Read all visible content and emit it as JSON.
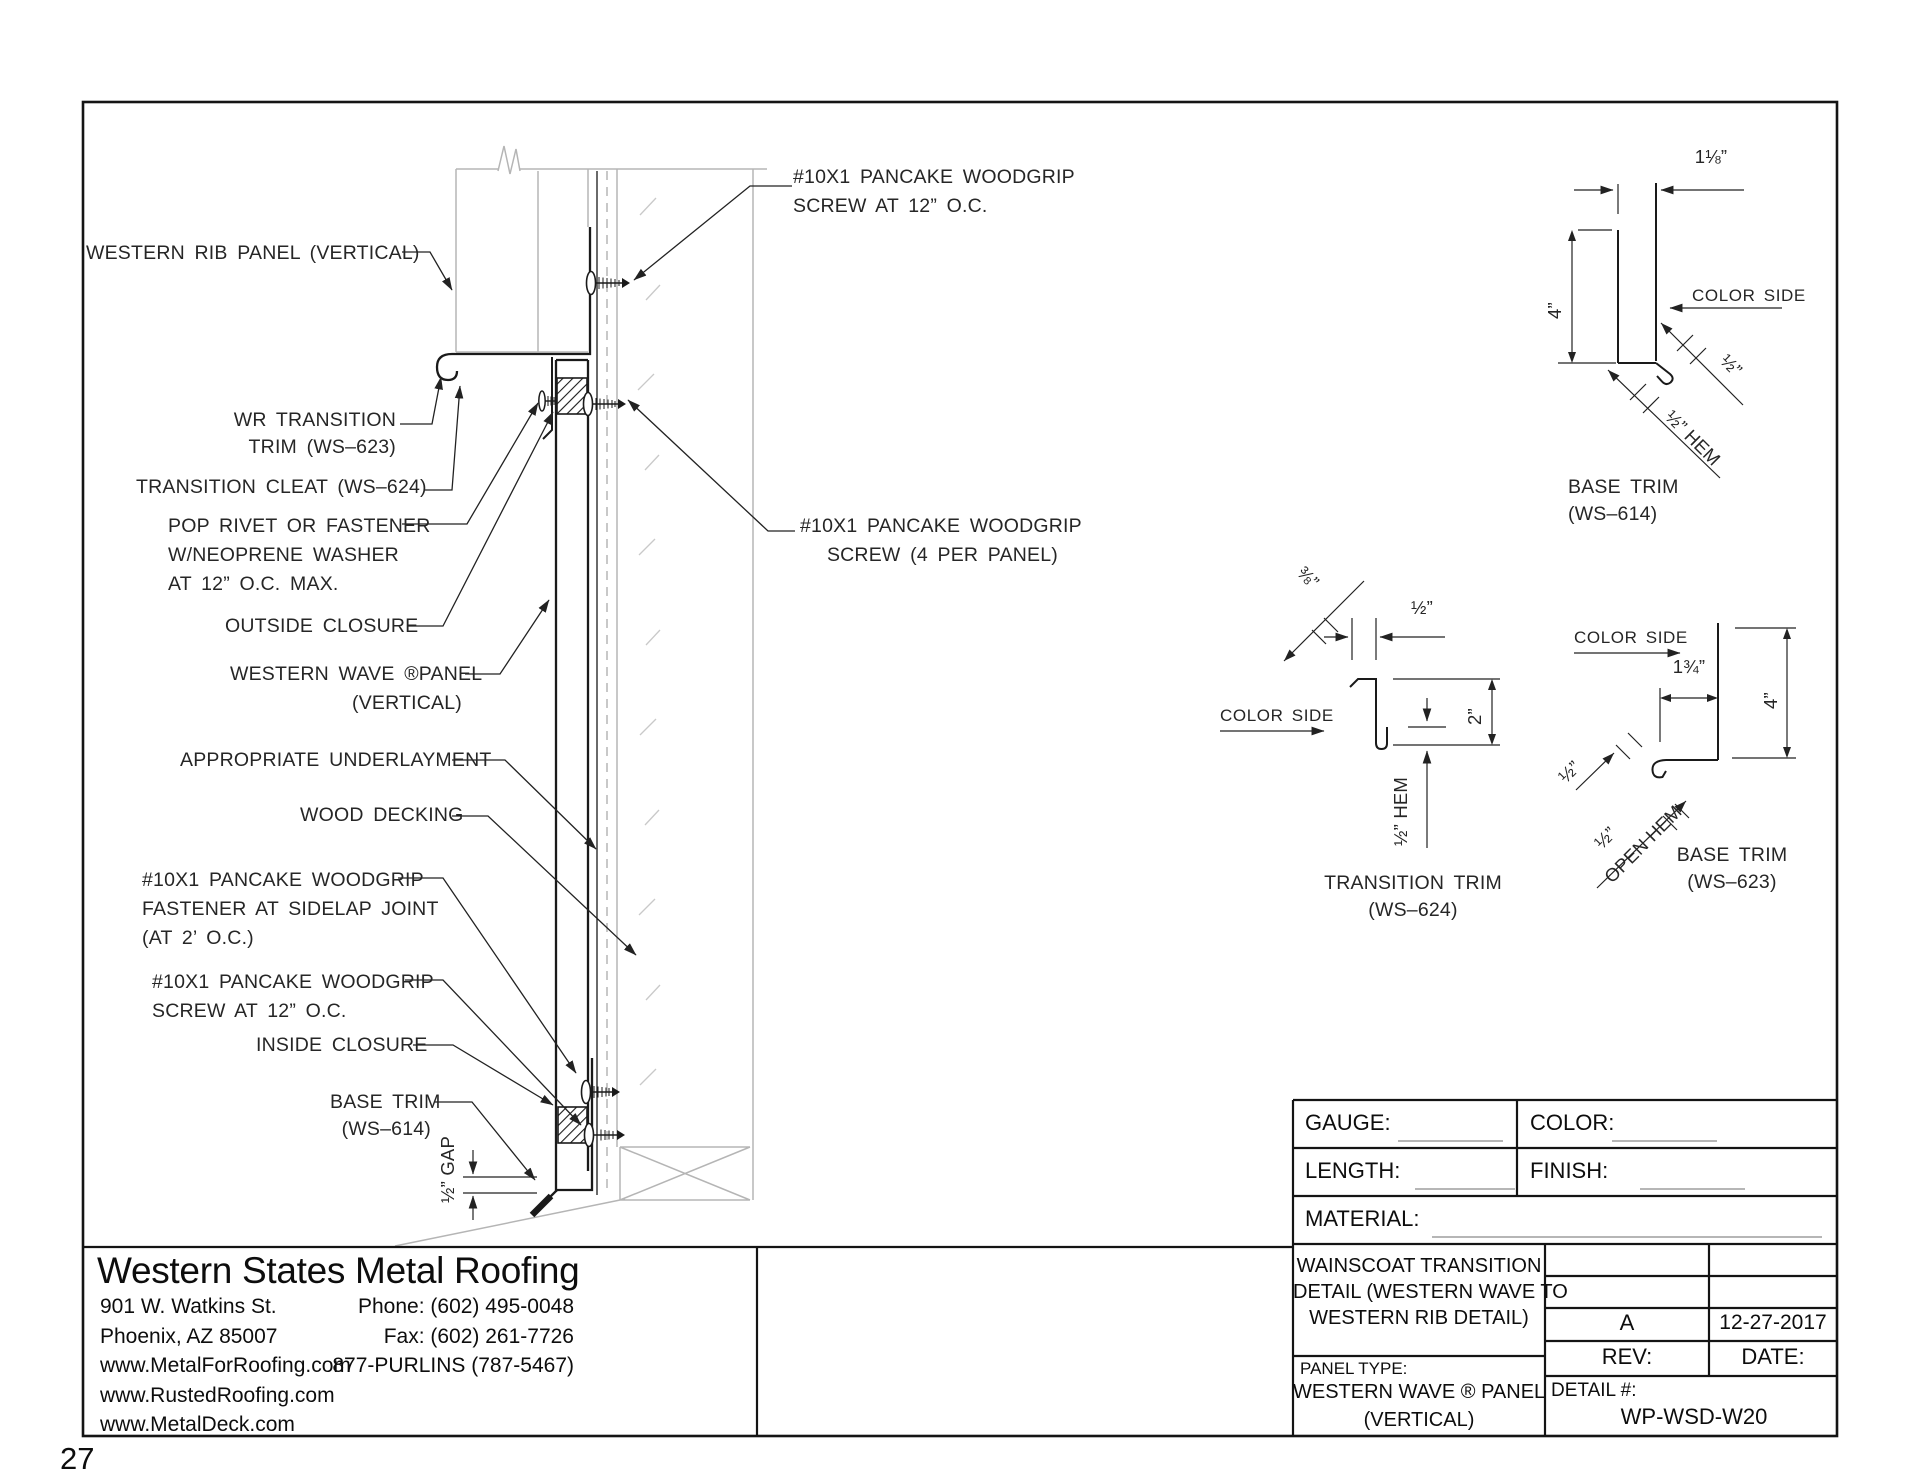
{
  "page_number": "27",
  "callouts": {
    "western_rib_panel": [
      "WESTERN RIB PANEL (VERTICAL)"
    ],
    "screw_top": [
      "#10X1 PANCAKE WOODGRIP",
      "SCREW AT 12” O.C."
    ],
    "wr_transition_trim": [
      "WR TRANSITION",
      "TRIM (WS–623)"
    ],
    "transition_cleat": [
      "TRANSITION CLEAT (WS–624)"
    ],
    "pop_rivet": [
      "POP RIVET OR FASTENER",
      "W/NEOPRENE WASHER",
      "AT 12” O.C. MAX."
    ],
    "outside_closure": [
      "OUTSIDE CLOSURE"
    ],
    "western_wave_panel": [
      "WESTERN WAVE ®PANEL",
      "(VERTICAL)"
    ],
    "screw_4_per_panel": [
      "#10X1 PANCAKE WOODGRIP",
      "SCREW (4 PER PANEL)"
    ],
    "underlayment": [
      "APPROPRIATE UNDERLAYMENT"
    ],
    "wood_decking": [
      "WOOD DECKING"
    ],
    "sidelap_fastener": [
      "#10X1 PANCAKE WOODGRIP",
      "FASTENER AT SIDELAP JOINT",
      "(AT 2’ O.C.)"
    ],
    "screw_bottom": [
      "#10X1 PANCAKE WOODGRIP",
      "SCREW AT 12” O.C."
    ],
    "inside_closure": [
      "INSIDE CLOSURE"
    ],
    "base_trim_614": [
      "BASE TRIM",
      "(WS–614)"
    ],
    "gap_dim": "½” GAP"
  },
  "details": {
    "ws614": {
      "title1": "BASE TRIM",
      "title2": "(WS–614)",
      "dim_top": "1⅛”",
      "dim_height": "4”",
      "color_side": "COLOR SIDE",
      "dim_face": "½”",
      "dim_hem": "½” HEM"
    },
    "ws624": {
      "title1": "TRANSITION TRIM",
      "title2": "(WS–624)",
      "dim_kick": "⅜”",
      "dim_top": "½”",
      "dim_height": "2”",
      "dim_hem": "½” HEM",
      "color_side": "COLOR SIDE"
    },
    "ws623": {
      "title1": "BASE TRIM",
      "title2": "(WS–623)",
      "color_side": "COLOR SIDE",
      "dim_top": "1¾”",
      "dim_height": "4”",
      "dim_face": "½”",
      "dim_hem1": "½”",
      "dim_hem2": "OPEN HEM"
    }
  },
  "title_block": {
    "gauge_label": "GAUGE:",
    "color_label": "COLOR:",
    "length_label": "LENGTH:",
    "finish_label": "FINISH:",
    "material_label": "MATERIAL:",
    "title_line1": "WAINSCOAT TRANSITION",
    "title_line2": "DETAIL (WESTERN WAVE TO",
    "title_line3": "WESTERN RIB DETAIL)",
    "panel_type_label": "PANEL TYPE:",
    "panel_type_line1": "WESTERN WAVE ® PANEL",
    "panel_type_line2": "(VERTICAL)",
    "rev_value": "A",
    "date_value": "12-27-2017",
    "rev_label": "REV:",
    "date_label": "DATE:",
    "detail_label": "DETAIL #:",
    "detail_value": "WP-WSD-W20"
  },
  "company": {
    "name": "Western States Metal Roofing",
    "address": [
      "901 W. Watkins St.",
      "Phoenix, AZ 85007",
      "www.MetalForRoofing.com",
      "www.RustedRoofing.com",
      "www.MetalDeck.com"
    ],
    "contact": [
      "Phone: (602) 495-0048",
      "Fax: (602) 261-7726",
      "877-PURLINS (787-5467)"
    ]
  }
}
